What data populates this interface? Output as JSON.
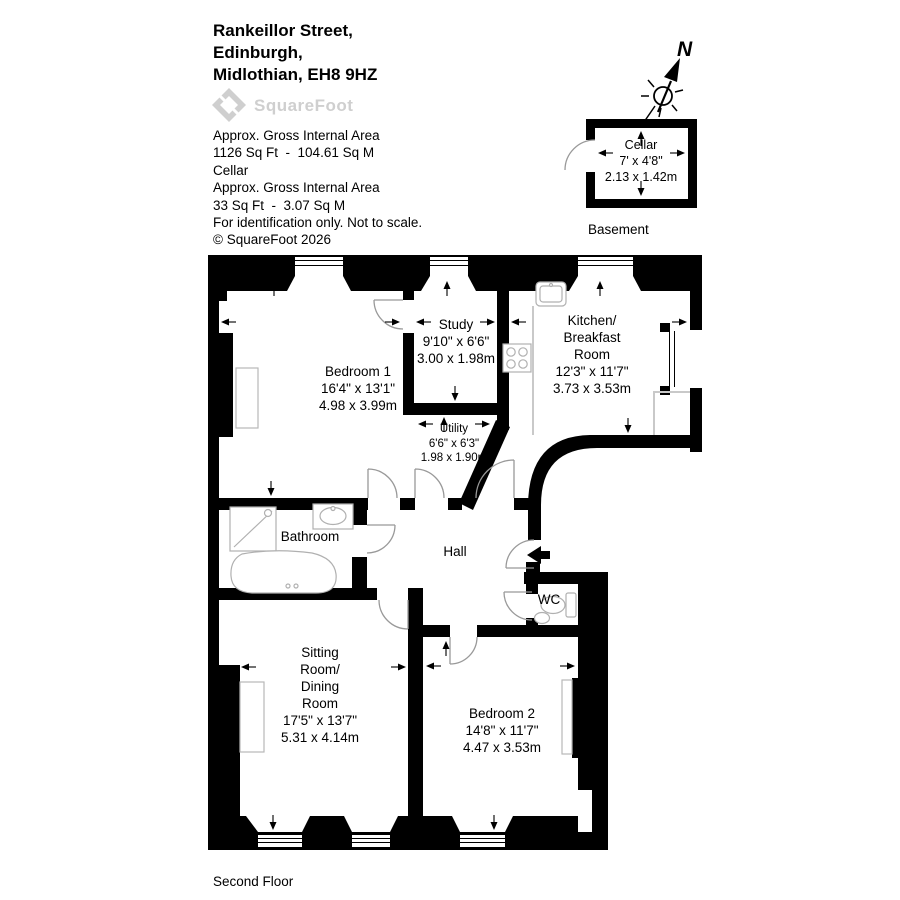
{
  "header": {
    "address_line1": "Rankeillor Street,",
    "address_line2": "Edinburgh,",
    "address_line3": "Midlothian, EH8 9HZ",
    "logo_text": "SquareFoot",
    "area_label1": "Approx. Gross Internal Area",
    "area_value1": "1126 Sq Ft  -  104.61 Sq M",
    "area_sublabel": "Cellar",
    "area_label2": "Approx. Gross Internal Area",
    "area_value2": "33 Sq Ft  -  3.07 Sq M",
    "disclaimer": "For identification only. Not to scale.",
    "copyright": "© SquareFoot 2026"
  },
  "compass": {
    "north_label": "N"
  },
  "floors": {
    "basement_label": "Basement",
    "main_label": "Second Floor"
  },
  "rooms": {
    "cellar": {
      "name": "Cellar",
      "imperial": "7' x 4'8\"",
      "metric": "2.13 x 1.42m"
    },
    "bedroom1": {
      "name": "Bedroom 1",
      "imperial": "16'4\" x 13'1\"",
      "metric": "4.98 x 3.99m"
    },
    "study": {
      "name": "Study",
      "imperial": "9'10\" x 6'6\"",
      "metric": "3.00 x 1.98m"
    },
    "kitchen": {
      "name1": "Kitchen/",
      "name2": "Breakfast",
      "name3": "Room",
      "imperial": "12'3\" x 11'7\"",
      "metric": "3.73 x 3.53m"
    },
    "utility": {
      "name": "Utility",
      "imperial": "6'6\" x 6'3\"",
      "metric": "1.98 x 1.90m"
    },
    "bathroom": {
      "name": "Bathroom"
    },
    "hall": {
      "name": "Hall"
    },
    "wc": {
      "name": "WC"
    },
    "sitting": {
      "name1": "Sitting",
      "name2": "Room/",
      "name3": "Dining",
      "name4": "Room",
      "imperial": "17'5\" x 13'7\"",
      "metric": "5.31 x 4.14m"
    },
    "bedroom2": {
      "name": "Bedroom 2",
      "imperial": "14'8\" x 11'7\"",
      "metric": "4.47 x 3.53m"
    }
  },
  "colors": {
    "wall": "#000000",
    "fixture_outline": "#b0b0b0",
    "counter": "#c9c9c9",
    "logo_gray": "#cfcfcf"
  }
}
